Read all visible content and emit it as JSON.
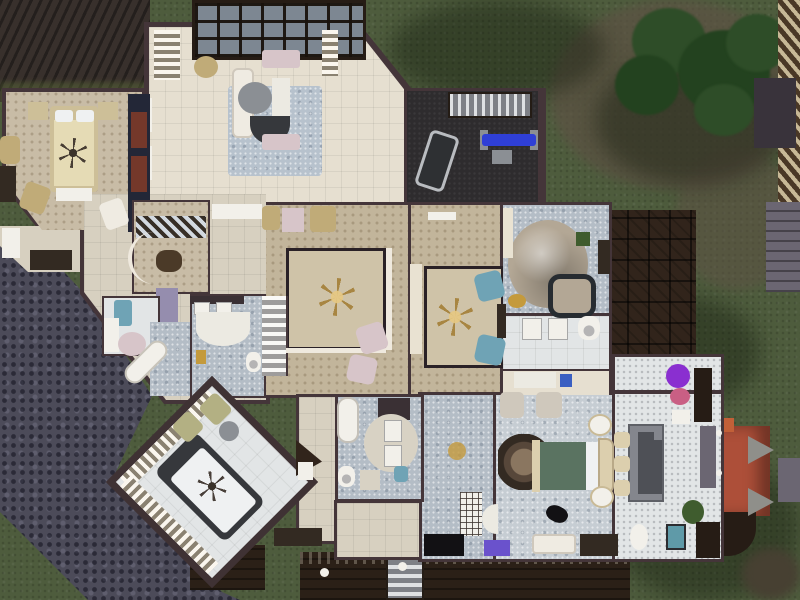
{
  "scene": {
    "description": "Top-down build-mode floor plan view of a large mansion upper floor in a life-simulation game, surrounded by lawn, stone patio roof, fences and a tree",
    "view": "overhead cutaway",
    "visible_text": "none"
  },
  "palette": {
    "grass": "#4e5c3d",
    "dirt": "#5d5244",
    "tree_dark": "#23421f",
    "tree_mid": "#2e4d28",
    "cobblestone": "#4c4b59",
    "shingle_roof": "#38302c",
    "flat_roof": "#31241b",
    "deck_wood": "#2b2017",
    "wall": "#443539",
    "frame_dark": "#261c15",
    "glass": "#7d8792",
    "floor_cream": "#e6dfd0",
    "floor_tan": "#c2b59b",
    "floor_floral": "#c8bca6",
    "floor_marble": "#b4bdc6",
    "floor_marble_light": "#c6cdd3",
    "floor_white": "#e2e5e6",
    "floor_beige": "#d7d0c0",
    "floor_gym": "#2e2c2e",
    "floor_lavender": "#958dae",
    "rug_blue": "#b7c2cd",
    "well_tan": "#cfc3a8",
    "dome": "#b3a795",
    "red_roof": "#ad4f39",
    "dormer": "#8f8f8a",
    "chimney": "#c26038",
    "hot_tub_rim": "#272c31",
    "bed_cream": "#e5dbb5",
    "bed_frame_cream": "#cdbf98",
    "headboard_cream": "#dccfae",
    "bed_green": "#5a7361",
    "bed_frame_dark": "#36383c",
    "mattress_white": "#eff1f2",
    "sofa_white": "#efebe2",
    "chair_pink": "#d7c5c9",
    "chair_teal": "#6fa3b5",
    "chair_olive": "#b3b083",
    "chair_gold": "#c0ab78",
    "chair_gray": "#cfc8bc",
    "wood_dark": "#332a22",
    "counter_dark": "#3a3034",
    "stone_table": "#84868d",
    "bench_dark": "#4e5056",
    "bench_blue": "#2f3fd6",
    "stairs_light": "#b9bdc2",
    "railing": "#efe9de",
    "porcelain": "#eceae2",
    "counter_light": "#d8d2c4",
    "mat_gray": "#8b8f94",
    "landing_brown": "#4b3a28",
    "cabinet_cream": "#e9e2d2",
    "closet_navy": "#232737",
    "shelf_red": "#74382a",
    "purple_flower": "#8a2fd0",
    "pink_bowl": "#c95f84",
    "plant_green": "#3f5c2e",
    "teal_bench": "#5f9aa8",
    "gold": "#c49a3c",
    "white": "#f2f0ea",
    "black": "#121114",
    "stool_blue": "#3a5fc2",
    "tv_purple": "#6a52cc",
    "fence_gray": "#6b6672",
    "dark_structure": "#39333b",
    "path_olive": "#474032"
  },
  "inventory": {
    "exterior": [
      "lawn with tree and cast shadows",
      "dirt patches",
      "slatted privacy fence",
      "dark garden structure",
      "cobblestone patio roof",
      "dark shingle roof",
      "flat tiled roof",
      "glass conservatory roof",
      "red turret roof with gray dormers and chimney",
      "wood deck with railing and lamps",
      "exterior stairs"
    ],
    "rooms": [
      "guest bedroom",
      "conservatory living room",
      "home gym",
      "stair landing with open well",
      "sitting room",
      "bay-window landing",
      "nursery",
      "three bathrooms",
      "dome spa room with hot tub",
      "vanity hall",
      "master bedroom",
      "diagonal corner bedroom",
      "dining room",
      "hallways"
    ],
    "furniture": [
      "double bed (cream)",
      "double bed (green with ornate headboard)",
      "diagonal bed (dark frame, white mattress)",
      "crib",
      "sofas and loveseats",
      "pink, teal, olive, gold and gray armchairs",
      "chandeliers",
      "ceiling fans",
      "treadmill",
      "blue weight bench",
      "staircases",
      "bathtubs",
      "round sink dais",
      "sinks",
      "toilets",
      "hot tub",
      "round dome",
      "stone dining table with chairs",
      "bookshelves",
      "cabinets",
      "TV",
      "potted purple flowers",
      "pink bowl plant",
      "green plant",
      "teal bench",
      "cats"
    ]
  }
}
